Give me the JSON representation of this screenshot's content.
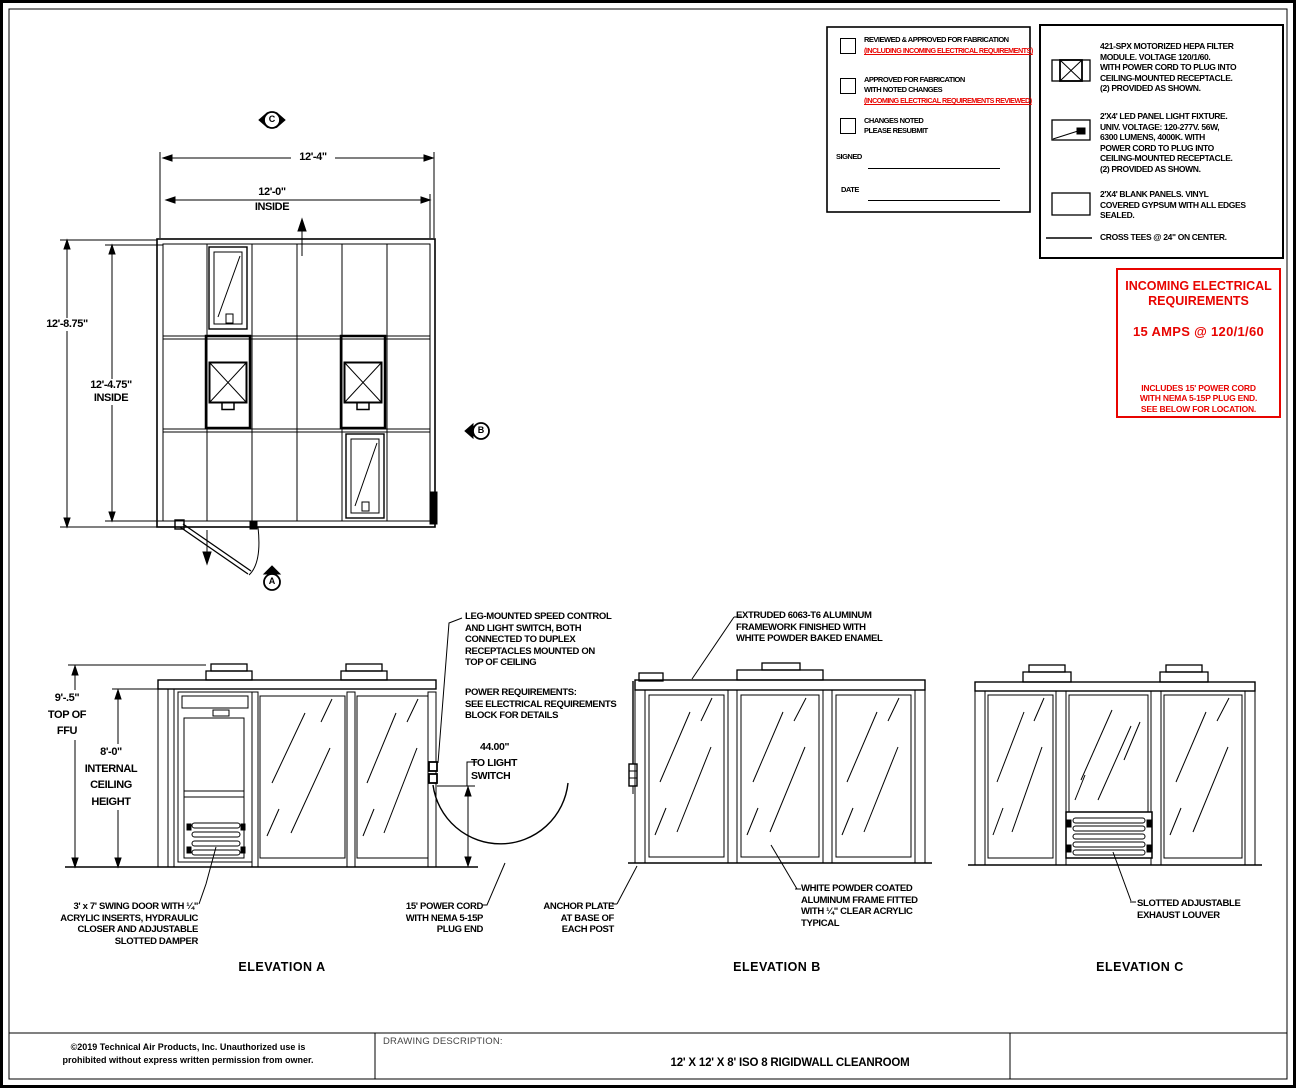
{
  "colors": {
    "line": "#000000",
    "red": "#e80400"
  },
  "approval": {
    "items": [
      {
        "title": "REVIEWED & APPROVED FOR FABRICATION",
        "red_note": "(INCLUDING INCOMING ELECTRICAL REQUIREMENTS)"
      },
      {
        "title": "APPROVED FOR FABRICATION\nWITH NOTED CHANGES",
        "red_note": "(INCOMING ELECTRICAL REQUIREMENTS REVIEWED)"
      },
      {
        "title": "CHANGES NOTED\nPLEASE RESUBMIT"
      }
    ],
    "signed_label": "SIGNED",
    "date_label": "DATE"
  },
  "legend": {
    "items": [
      {
        "symbol": "hepa-filter-symbol",
        "text": "421-SPX MOTORIZED HEPA FILTER\nMODULE. VOLTAGE 120/1/60.\nWITH POWER CORD TO PLUG INTO\nCEILING-MOUNTED RECEPTACLE.\n(2) PROVIDED AS SHOWN."
      },
      {
        "symbol": "led-light-symbol",
        "text": "2'X4' LED PANEL LIGHT FIXTURE.\nUNIV. VOLTAGE: 120-277V.  56W,\n6300 LUMENS, 4000K. WITH\nPOWER CORD TO PLUG INTO\nCEILING-MOUNTED RECEPTACLE.\n(2) PROVIDED AS SHOWN."
      },
      {
        "symbol": "blank-panel-symbol",
        "text": "2'X4' BLANK PANELS. VINYL\nCOVERED GYPSUM WITH ALL EDGES\nSEALED."
      },
      {
        "symbol": "cross-tee-symbol",
        "text": "CROSS TEES @ 24\" ON CENTER."
      }
    ]
  },
  "electrical": {
    "title": "INCOMING ELECTRICAL\nREQUIREMENTS",
    "rating": "15 AMPS @ 120/1/60",
    "note": "INCLUDES 15' POWER CORD\nWITH NEMA 5-15P PLUG END.\nSEE BELOW FOR LOCATION."
  },
  "plan": {
    "dim_overall_width": "12'-4\"",
    "dim_inside_width": "12'-0\"",
    "inside_label_w": "INSIDE",
    "dim_overall_height": "12'-8.75\"",
    "dim_inside_height": "12'-4.75\"\nINSIDE",
    "marker_a": "A",
    "marker_b": "B",
    "marker_c": "C"
  },
  "elev_a": {
    "dim_ffu": "9'-.5\"\nTOP OF\nFFU",
    "dim_ceiling": "8'-0\"\nINTERNAL\nCEILING\nHEIGHT",
    "note_speed_control": "LEG-MOUNTED SPEED CONTROL\nAND LIGHT SWITCH, BOTH\nCONNECTED TO DUPLEX\nRECEPTACLES MOUNTED ON\nTOP OF CEILING",
    "note_power_req": "POWER REQUIREMENTS:\nSEE ELECTRICAL REQUIREMENTS\nBLOCK FOR DETAILS",
    "dim_switch": "44.00\"",
    "dim_switch_label": "TO LIGHT\nSWITCH",
    "note_door": "3' x 7' SWING DOOR WITH ¼\"\nACRYLIC INSERTS, HYDRAULIC\nCLOSER AND ADJUSTABLE\nSLOTTED DAMPER",
    "note_cord": "15' POWER CORD\nWITH NEMA 5-15P\nPLUG END",
    "label": "ELEVATION A"
  },
  "elev_b": {
    "note_frame": "EXTRUDED 6063-T6 ALUMINUM\nFRAMEWORK FINISHED WITH\nWHITE POWDER BAKED ENAMEL",
    "note_anchor": "ANCHOR PLATE\nAT BASE OF\nEACH POST",
    "note_acrylic": "WHITE POWDER COATED\nALUMINUM FRAME FITTED\nWITH ¼\" CLEAR ACRYLIC\nTYPICAL",
    "label": "ELEVATION B"
  },
  "elev_c": {
    "note_louver": "SLOTTED ADJUSTABLE\nEXHAUST LOUVER",
    "label": "ELEVATION C"
  },
  "title_block": {
    "copyright": "©2019 Technical Air Products, Inc.  Unauthorized use is\nprohibited without express written permission from owner.",
    "description_label": "DRAWING DESCRIPTION:",
    "title": "12' X 12' X 8' ISO 8 RIGIDWALL CLEANROOM"
  }
}
